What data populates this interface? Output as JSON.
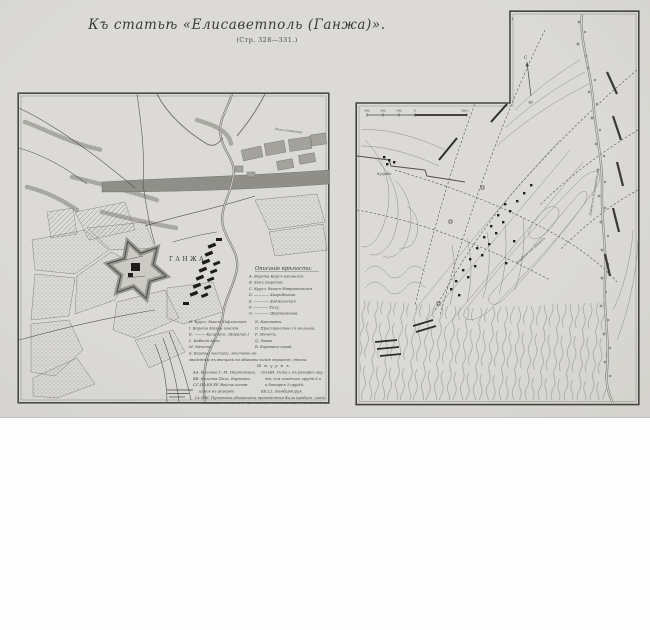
{
  "page": {
    "title": "Къ статьѣ «Елисаветполь (Ганжа)».",
    "subtitle": "(Стр. 328—331.)"
  },
  "left_map": {
    "city_label": "ГАНЖА",
    "river_label": "Рѣка Ганжинка",
    "legend": {
      "heading": "Описаніе крѣпости:",
      "items_a": [
        "А. Ворота Карсъ-капинскія.",
        "В. Ханъ (ворота).",
        "С. Кругл. башня Мавританская.",
        "D. ———— Хазрибекова.",
        "Е. ———— Хаджимская.",
        "F. ———— Халу.",
        "G. ———— Шармазанова."
      ],
      "items_b_left": [
        "Н. Кругл. башня Тифлисская.",
        "I. Ворота Мазры ханскія.",
        "К. ——— Кала ханс. (Карапап.)",
        "L. Кабачій валъ.",
        "М. Мечеть.",
        "S. Казачьи мостики, мѣстами во-"
      ],
      "items_b_right": [
        "N. Казематы.",
        "О. Пространство съ мельниц.",
        "Р. Мечеть.",
        "Q. Лавки.",
        "R. Караванъ-сарай."
      ],
      "note": "зведенные въ вѣнцахъ на обывательскія строенія, стѣна.",
      "assault_heading": "Ш т у р м ъ.",
      "assault_left": [
        "АА. Колонна Г.-М. Портнягина.",
        "ВВ. Колонна Полк. Карягина.",
        "СС.DD.ЕЕ.FF. Войска остав-",
        "шіяся въ резервѣ."
      ],
      "assault_right": [
        "GG.НН. Остал. въ резервѣ ору-",
        "дія, для осадныхъ орудій 6 и",
        "и батарея 3 орудій.",
        "КК.LL. Бомбардируя."
      ],
      "footnote1": "LL.ММ. Пунктами обозначены проведенныя были прибыт. линіи",
      "footnote2": "колоннами: ихъ №1-й у., на 1-мъ кол. Портнягина, а №2-мъ Карягина."
    }
  },
  "right_map": {
    "north_top": "С",
    "north_bottom": "Ю",
    "scale_labels": [
      "300",
      "200",
      "100",
      "0",
      "500 с."
    ],
    "road_label_1": "Зазубани или Дзегамъ",
    "road_label_2": "Дорога изъ Елисаветполя",
    "village_label": "Кулраба"
  }
}
